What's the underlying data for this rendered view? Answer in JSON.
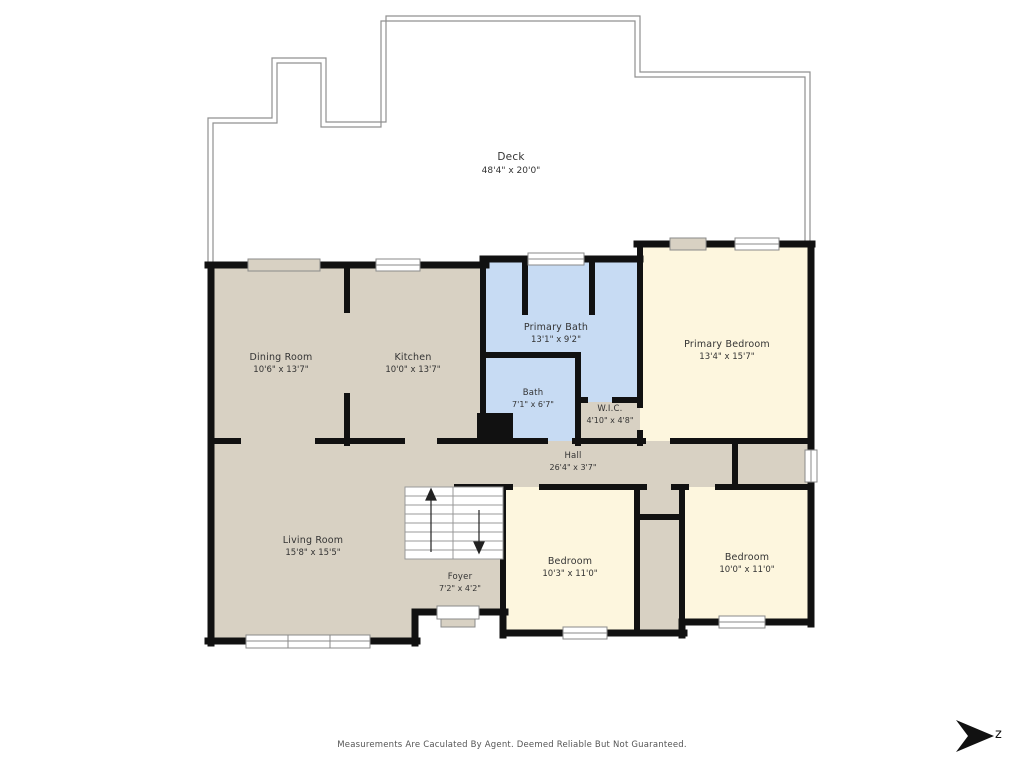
{
  "rooms": [
    {
      "id": "deck",
      "name": "Deck",
      "dims": "48'4\" x 20'0\""
    },
    {
      "id": "dining-room",
      "name": "Dining Room",
      "dims": "10'6\" x 13'7\""
    },
    {
      "id": "kitchen",
      "name": "Kitchen",
      "dims": "10'0\" x 13'7\""
    },
    {
      "id": "primary-bath",
      "name": "Primary Bath",
      "dims": "13'1\" x 9'2\""
    },
    {
      "id": "primary-bedroom",
      "name": "Primary Bedroom",
      "dims": "13'4\" x 15'7\""
    },
    {
      "id": "bath",
      "name": "Bath",
      "dims": "7'1\" x 6'7\""
    },
    {
      "id": "wic",
      "name": "W.I.C.",
      "dims": "4'10\" x 4'8\""
    },
    {
      "id": "hall",
      "name": "Hall",
      "dims": "26'4\" x 3'7\""
    },
    {
      "id": "living-room",
      "name": "Living Room",
      "dims": "15'8\" x 15'5\""
    },
    {
      "id": "foyer",
      "name": "Foyer",
      "dims": "7'2\" x 4'2\""
    },
    {
      "id": "bedroom-1",
      "name": "Bedroom",
      "dims": "10'3\" x 11'0\""
    },
    {
      "id": "bedroom-2",
      "name": "Bedroom",
      "dims": "10'0\" x 11'0\""
    }
  ],
  "compass": {
    "label": "z"
  },
  "footer": {
    "disclaimer": "Measurements Are Caculated By Agent. Deemed Reliable But Not Guaranteed."
  },
  "colors": {
    "beige": "#d8d1c3",
    "cream": "#fdf6de",
    "blue": "#c7dbf3",
    "wall": "#111111",
    "line": "#909090",
    "text": "#333333",
    "muted": "#555555"
  }
}
